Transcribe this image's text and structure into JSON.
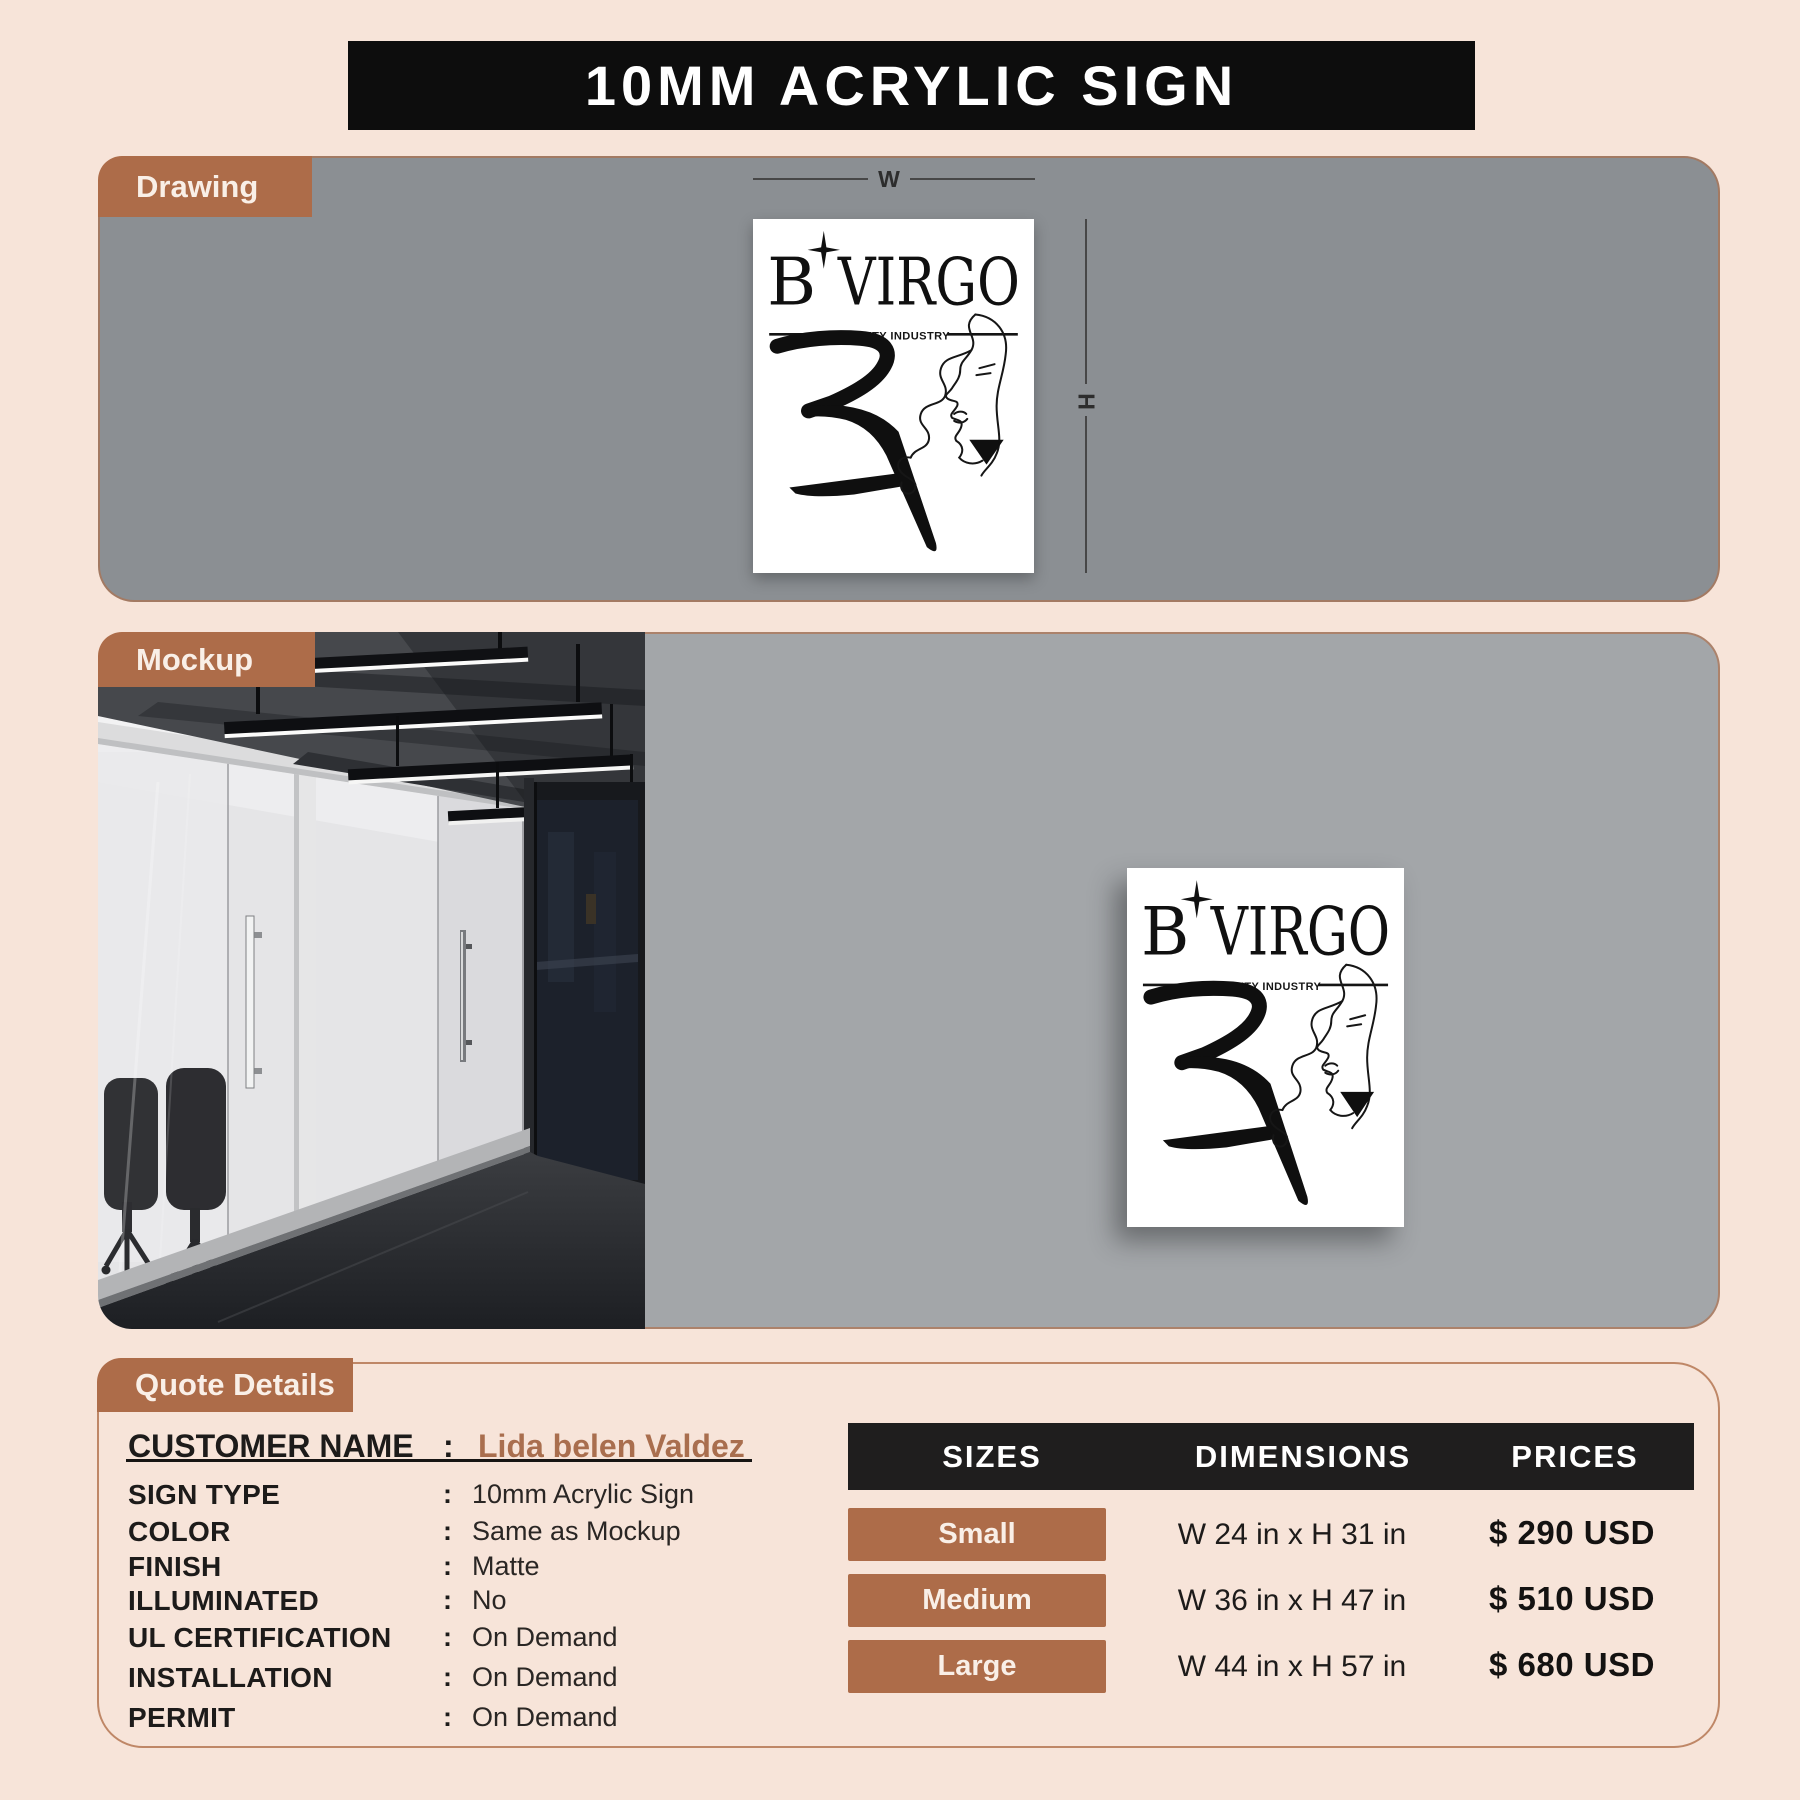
{
  "title": "10MM ACRYLIC SIGN",
  "drawing": {
    "tab": "Drawing",
    "width_label": "W",
    "height_label": "H"
  },
  "mockup": {
    "tab": "Mockup"
  },
  "logo": {
    "b": "B",
    "name": "VIRGO",
    "tagline": "BEAUTY INDUSTRY"
  },
  "quote": {
    "tab": "Quote Details",
    "customer_label": "CUSTOMER NAME",
    "colon": ":",
    "customer_name": "Lida belen Valdez",
    "fields": [
      {
        "label": "SIGN TYPE",
        "colon": ":",
        "value": "10mm Acrylic Sign"
      },
      {
        "label": "COLOR",
        "colon": ":",
        "value": "Same as Mockup"
      },
      {
        "label": "FINISH",
        "colon": ":",
        "value": "Matte"
      },
      {
        "label": "ILLUMINATED",
        "colon": ":",
        "value": "No"
      },
      {
        "label": "UL CERTIFICATION",
        "colon": ":",
        "value": "On Demand"
      },
      {
        "label": "INSTALLATION",
        "colon": ":",
        "value": "On Demand"
      },
      {
        "label": "PERMIT",
        "colon": ":",
        "value": "On Demand"
      }
    ]
  },
  "pricing": {
    "headers": [
      "SIZES",
      "DIMENSIONS",
      "PRICES"
    ],
    "rows": [
      {
        "size": "Small",
        "dimensions": "W 24 in x H 31 in",
        "price": "$ 290 USD"
      },
      {
        "size": "Medium",
        "dimensions": "W 36 in x H 47 in",
        "price": "$ 510 USD"
      },
      {
        "size": "Large",
        "dimensions": "W 44 in x H 57 in",
        "price": "$ 680 USD"
      }
    ]
  },
  "colors": {
    "page_bg": "#f7e4d9",
    "accent_brown": "#ad6c49",
    "bar_black": "#0d0d0d",
    "drawing_panel_gray": "#8b8f93",
    "mockup_wall_gray": "#a3a6a9",
    "customer_name_brown": "#a96e4e"
  }
}
